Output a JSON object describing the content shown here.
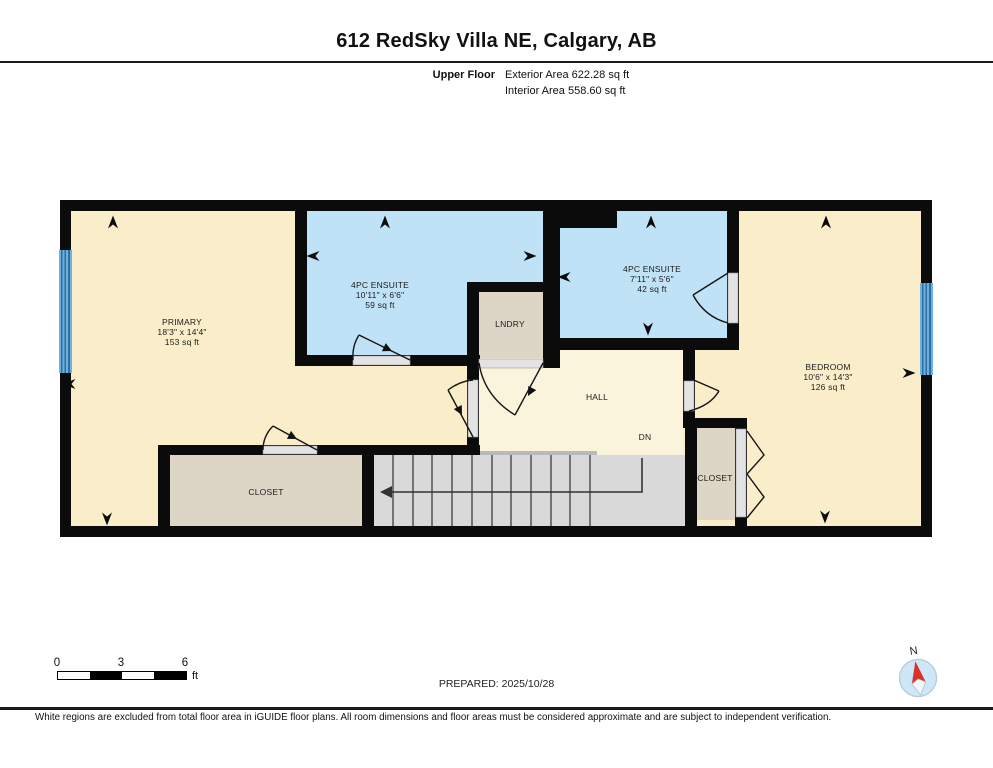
{
  "header": {
    "title": "612 RedSky Villa NE, Calgary, AB",
    "floor_label": "Upper Floor",
    "exterior_area_label": "Exterior Area 622.28 sq ft",
    "interior_area_label": "Interior Area 558.60 sq ft"
  },
  "plan": {
    "rooms": {
      "primary": {
        "name": "PRIMARY",
        "dims": "18'3\" x 14'4\"",
        "area": "153 sq ft"
      },
      "ensuite1": {
        "name": "4PC ENSUITE",
        "dims": "10'11\" x 6'6\"",
        "area": "59 sq ft"
      },
      "laundry": {
        "name": "LNDRY"
      },
      "ensuite2": {
        "name": "4PC ENSUITE",
        "dims": "7'11\" x 5'6\"",
        "area": "42 sq ft"
      },
      "bedroom": {
        "name": "BEDROOM",
        "dims": "10'6\" x 14'3\"",
        "area": "126 sq ft"
      },
      "hall": {
        "name": "HALL"
      },
      "closet1": {
        "name": "CLOSET"
      },
      "closet2": {
        "name": "CLOSET"
      },
      "stairs_label": "DN"
    }
  },
  "scale_bar": {
    "tick0": "0",
    "tick1": "3",
    "tick2": "6",
    "unit": "ft"
  },
  "prepared_label": "PREPARED: 2025/10/28",
  "compass": {
    "north_label": "N"
  },
  "disclaimer": "White regions are excluded from total floor area in iGUIDE floor plans. All room dimensions and floor areas must be considered approximate and are subject to independent verification.",
  "colors": {
    "wall": "#0b0b0b",
    "room_fill": "#f9edca",
    "hall_fill": "#fbf4dd",
    "bathroom_fill": "#bfe2f7",
    "closet_fill": "#ddd5c6",
    "stairs_fill": "#d9d9d9",
    "window_blue": "#5fa8d8",
    "threshold": "#e3e3e3",
    "compass_needle_red": "#d8322a"
  }
}
